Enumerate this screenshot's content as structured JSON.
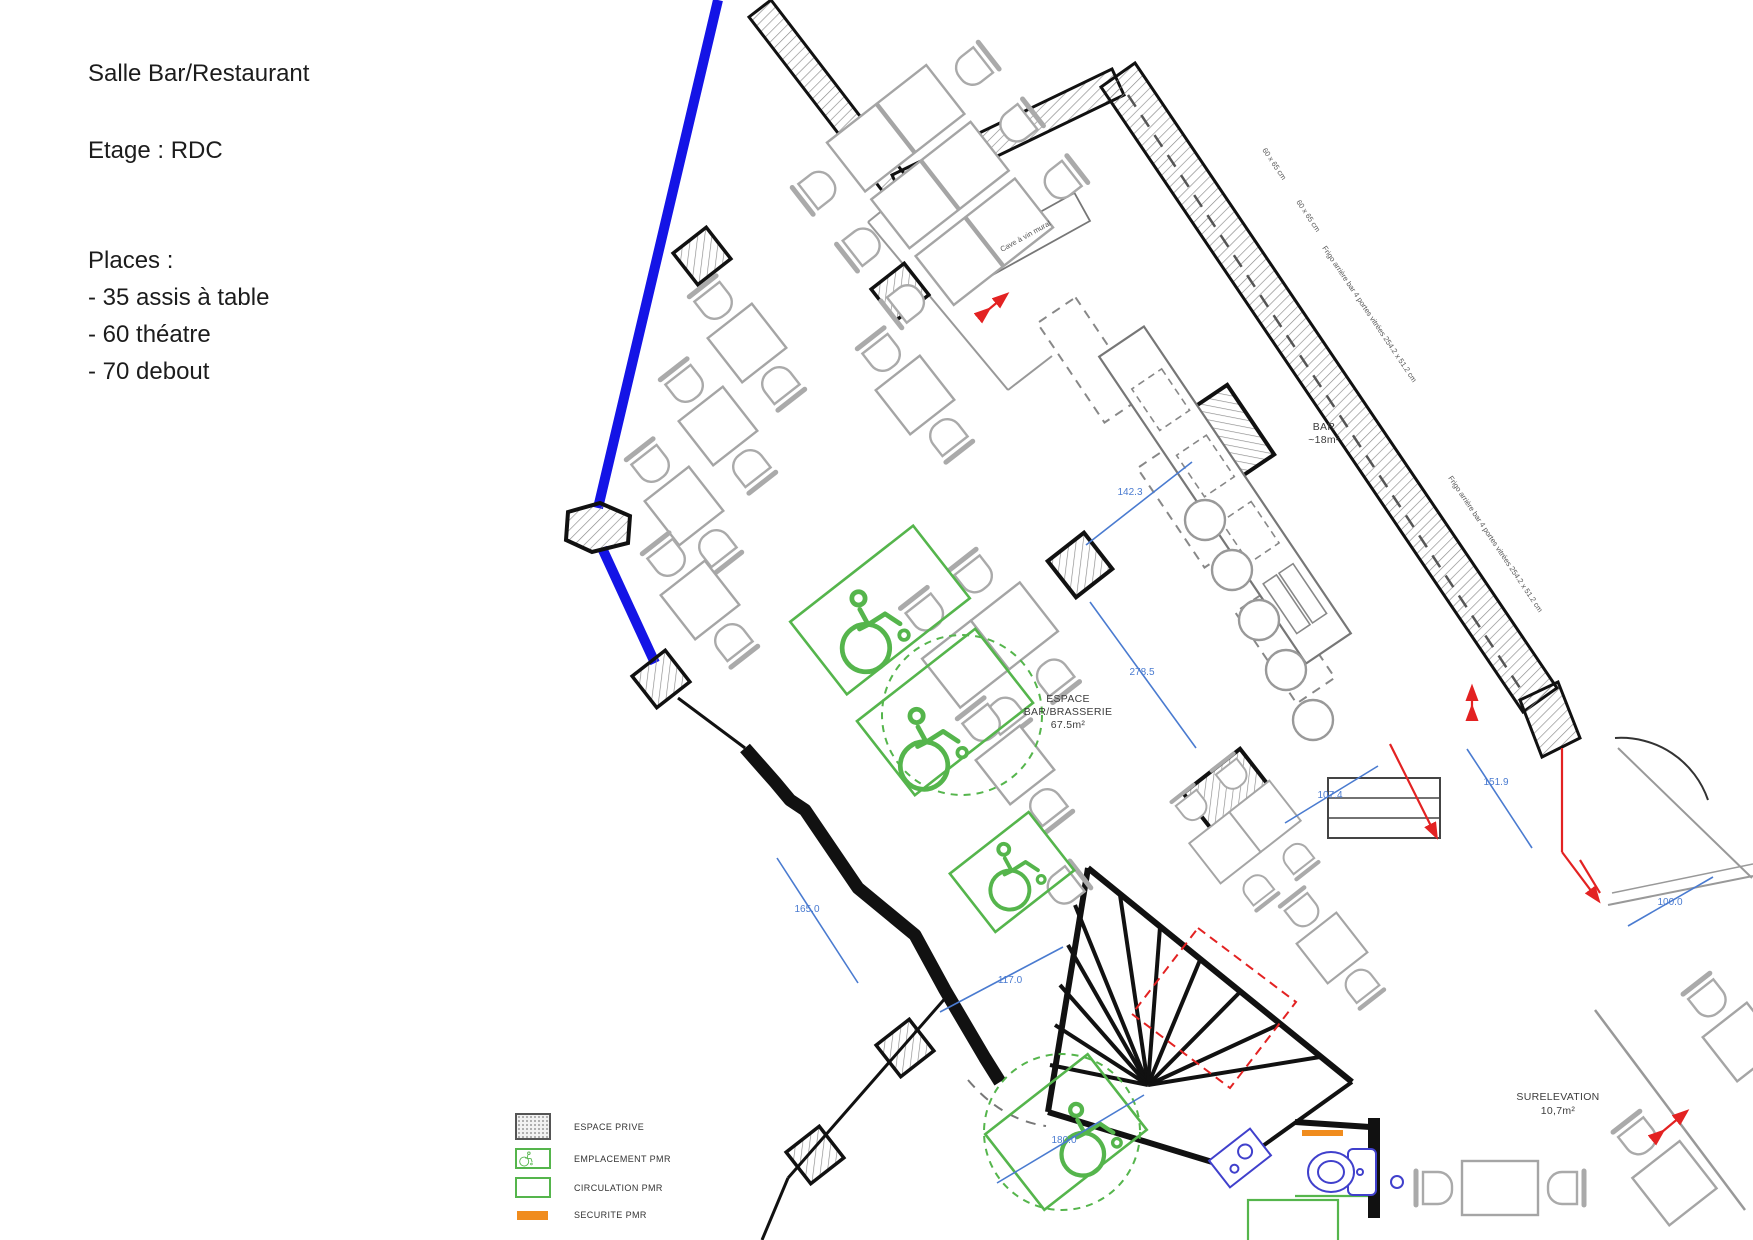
{
  "info": {
    "title": "Salle Bar/Restaurant",
    "floor": "Etage : RDC",
    "places_heading": "Places :",
    "places": [
      "- 35 assis à table",
      "- 60 théatre",
      "- 70 debout"
    ]
  },
  "rooms": {
    "bar": {
      "name": "BAR",
      "area": "~18m²"
    },
    "brasserie": {
      "line1": "ESPACE",
      "line2": "BAR/BRASSERIE",
      "area": "67.5m²"
    },
    "surelevation": {
      "name": "SURELEVATION",
      "area": "10,7m²"
    }
  },
  "equipment": {
    "cave": "Cave à vin mural",
    "frigo": "Frigo arrière bar 4 portes vitrées 254.2 x 51.2 cm",
    "dim_60x65": "60 x 65 cm"
  },
  "dimensions": [
    "142.3",
    "278.5",
    "107.4",
    "151.9",
    "165.0",
    "117.0",
    "180.0",
    "100.0"
  ],
  "legend": {
    "items": [
      {
        "label": "ESPACE PRIVE"
      },
      {
        "label": "EMPLACEMENT PMR"
      },
      {
        "label": "CIRCULATION PMR"
      },
      {
        "label": "SECURITE PMR"
      }
    ]
  },
  "colors": {
    "facade_blue": "#1414e6",
    "dimension_blue": "#4a7bd0",
    "pmr_green": "#55b54c",
    "securite_orange": "#f08c1e",
    "alert_red": "#e32222",
    "wall_black": "#111111",
    "furniture_gray": "#aaaaaa"
  }
}
